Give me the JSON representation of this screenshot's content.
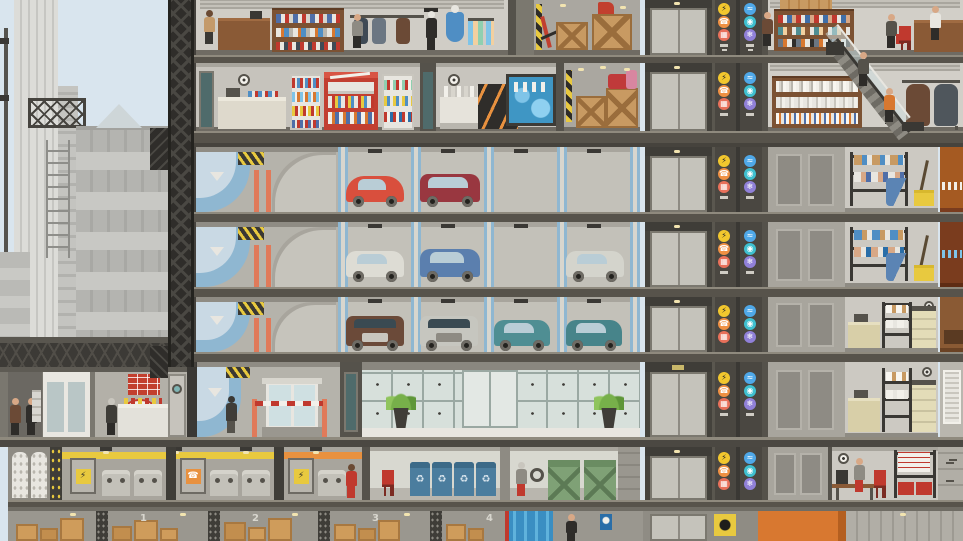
{
  "meta": {
    "title": "High-rise building cross-section",
    "genre": "tower management simulation",
    "view": "side cutaway with city backdrop"
  },
  "icons": {
    "power": {
      "glyph": "⚡",
      "color": "#f2c72e",
      "name": "electricity riser"
    },
    "phone": {
      "glyph": "☎",
      "color": "#ef9043",
      "name": "phone riser"
    },
    "grid": {
      "glyph": "▦",
      "color": "#e8705a",
      "name": "gas/conduit riser"
    },
    "water": {
      "glyph": "≈",
      "color": "#4fa8e8",
      "name": "water riser"
    },
    "vent": {
      "glyph": "◉",
      "color": "#3fc0d0",
      "name": "ventilation riser"
    },
    "hvac": {
      "glyph": "❄",
      "color": "#9080d8",
      "name": "hvac riser"
    },
    "recycle": {
      "glyph": "♻",
      "color": "#d8e4ec",
      "name": "recycling bin"
    }
  },
  "floors": [
    {
      "id": "F7",
      "label": "retail: clothing store, stockroom, shoe store"
    },
    {
      "id": "F6",
      "label": "retail: convenience store, liquor store, stockroom, bookstore"
    },
    {
      "id": "P1",
      "label": "parking level 1 with ramp"
    },
    {
      "id": "P2",
      "label": "parking level 2 with ramp"
    },
    {
      "id": "P3",
      "label": "parking level 3 with ramp"
    },
    {
      "id": "G",
      "label": "street level: shops, hot-dog stand, garage entrance, glass lobby, copy room"
    },
    {
      "id": "B1",
      "label": "basement: water tanks, generators, recycling, dumpsters, break room"
    },
    {
      "id": "B2",
      "label": "sub-basement: numbered storage cellars"
    }
  ],
  "cars": [
    {
      "level": "P1",
      "color": "#d94f3d",
      "type": "coupe"
    },
    {
      "level": "P1",
      "color": "#993740",
      "type": "wagon"
    },
    {
      "level": "P2",
      "color": "#dddcd4",
      "type": "sedan"
    },
    {
      "level": "P2",
      "color": "#5b7fae",
      "type": "sedan"
    },
    {
      "level": "P2",
      "color": "#d4d4cc",
      "type": "sedan"
    },
    {
      "level": "P3",
      "color": "#6b4a39",
      "type": "truck"
    },
    {
      "level": "P3",
      "color": "#c6c6bf",
      "type": "truck"
    },
    {
      "level": "P3",
      "color": "#4f8e93",
      "type": "sedan"
    },
    {
      "level": "P3",
      "color": "#47848a",
      "type": "sedan"
    }
  ],
  "basement": {
    "numbers": [
      "1",
      "2",
      "3",
      "4"
    ]
  },
  "palette": {
    "sky": "#d9e5ee",
    "slab": "#57534b",
    "room_gray": "#ccc9c2",
    "shaft": "#4a4741",
    "parking_stripe": "#8fb7d1",
    "hazard_yellow": "#e8c93f",
    "utility_orange": "#e8913f",
    "bin_blue": "#4b7d9e",
    "dumpster_green": "#7fa176",
    "fridge_red": "#c23f31",
    "lobby_glass": "#d7e0db",
    "wood": "#7c5233",
    "accent_red": "#c0392e"
  }
}
